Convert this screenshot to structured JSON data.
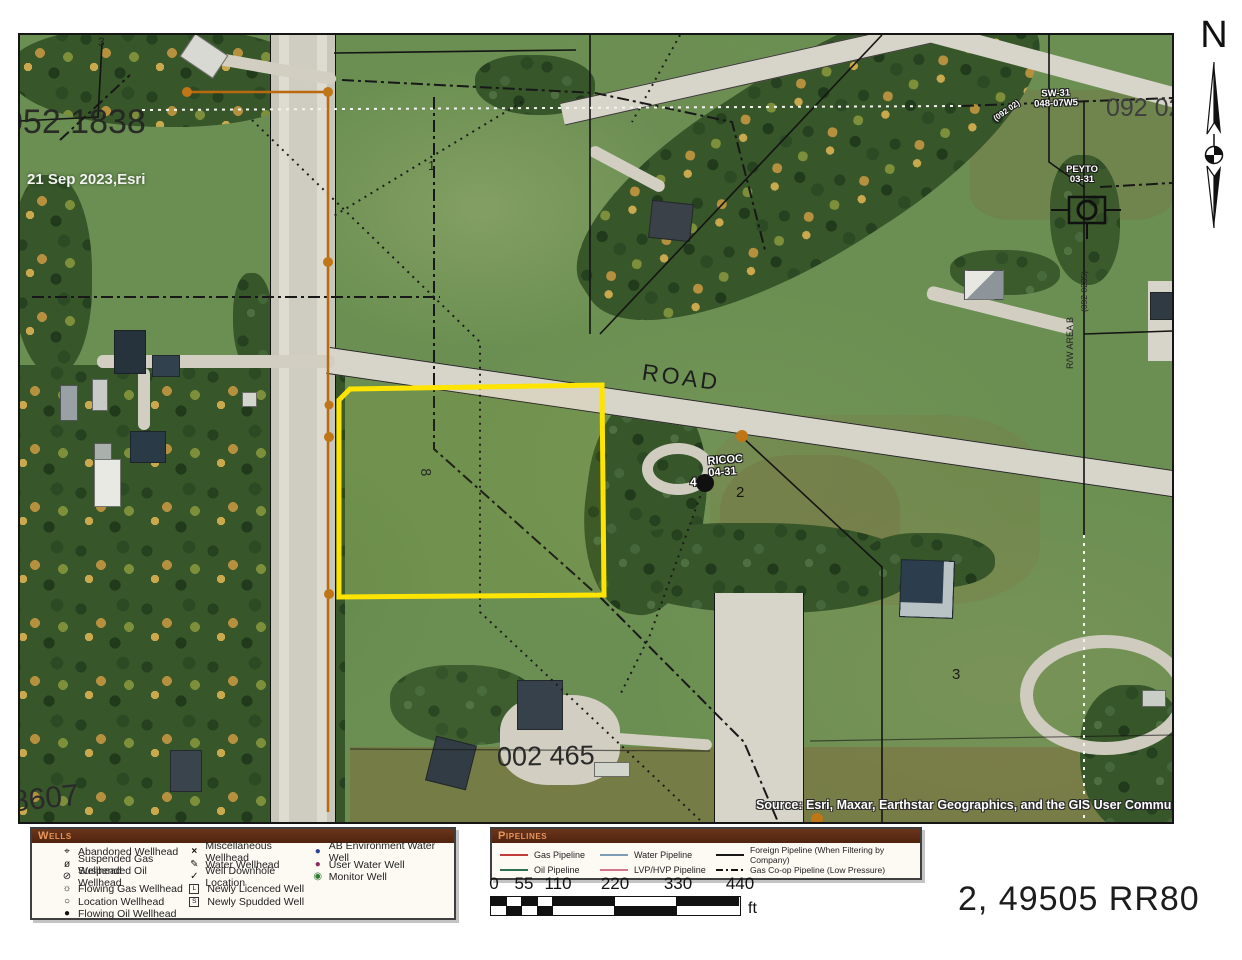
{
  "map": {
    "highlight_color": "#ffe400",
    "pipeline_color": "#b96a10",
    "labels": {
      "plan_top_left": "052 1838",
      "imagery_date": "21 Sep 2023,Esri",
      "parcel_3_top": "3",
      "parcel_1": "1",
      "parcel_2": "2",
      "parcel_3": "3",
      "parcel_8": "8",
      "well_sw31_line1": "SW-31",
      "well_sw31_line2": "048-07W5",
      "plan_092_02": "092 02",
      "plan_092_02_small": "(092 02)",
      "peyto_line1": "PEYTO",
      "peyto_line2": "03-31",
      "rw_area_b": "R/W AREA B",
      "rw_plan": "(092 0235)",
      "road": "ROAD",
      "ricoc_line1": "RICOC",
      "ricoc_line2": "04-31",
      "well_number_4": "4",
      "plan_002_465": "002 465",
      "plan_8607": "8607",
      "attribution": "Source: Esri, Maxar, Earthstar Geographics, and the GIS User Community"
    }
  },
  "north": {
    "label": "N"
  },
  "legend_wells": {
    "title": "Wells",
    "columns": [
      {
        "items": [
          {
            "glyph": "⌖",
            "label": "Abandoned Wellhead"
          },
          {
            "glyph": "ø",
            "label": "Suspended Gas Wellhead"
          },
          {
            "glyph": "⊘",
            "label": "Suspended Oil Wellhead"
          },
          {
            "glyph": "☼",
            "label": "Flowing Gas Wellhead"
          },
          {
            "glyph": "○",
            "label": "Location Wellhead"
          },
          {
            "glyph": "●",
            "label": "Flowing Oil Wellhead"
          }
        ]
      },
      {
        "items": [
          {
            "glyph": "×",
            "label": "Miscellaneous Wellhead"
          },
          {
            "glyph": "✎",
            "label": "Water Wellhead"
          },
          {
            "glyph": "✓",
            "label": "Well Downhole Location"
          },
          {
            "glyph": "L",
            "label": "Newly Licenced Well"
          },
          {
            "glyph": "S",
            "label": "Newly Spudded Well"
          }
        ]
      },
      {
        "items": [
          {
            "glyph": "●",
            "label": "AB Environment Water Well",
            "color": "#2b3f9e"
          },
          {
            "glyph": "●",
            "label": "User Water Well",
            "color": "#8c2f63"
          },
          {
            "glyph": "◉",
            "label": "Monitor Well",
            "color": "#2e7d32"
          }
        ]
      }
    ]
  },
  "legend_pipelines": {
    "title": "Pipelines",
    "columns": [
      {
        "items": [
          {
            "label": "Gas Pipeline",
            "color": "#c23b3b"
          },
          {
            "label": "Oil Pipeline",
            "color": "#2e6e52"
          }
        ]
      },
      {
        "items": [
          {
            "label": "Water Pipeline",
            "color": "#7d9cb5"
          },
          {
            "label": "LVP/HVP Pipeline",
            "color": "#d4748c"
          }
        ]
      },
      {
        "items": [
          {
            "label": "Foreign Pipeline (When Filtering by Company)",
            "color": "#181818"
          },
          {
            "label": "Gas Co-op Pipeline (Low Pressure)",
            "color": "#181818"
          }
        ]
      }
    ]
  },
  "scale_bar": {
    "ticks": [
      "0",
      "55",
      "110",
      "220",
      "330",
      "440"
    ],
    "unit": "ft"
  },
  "sheet_label": "2, 49505 RR80"
}
